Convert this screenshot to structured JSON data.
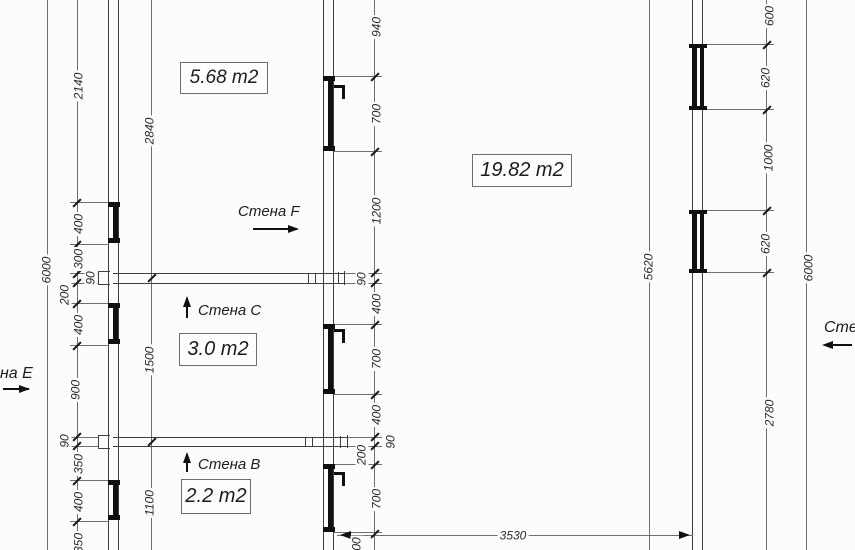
{
  "rooms": [
    {
      "label": "5.68 m2"
    },
    {
      "label": "19.82 m2"
    },
    {
      "label": "3.0 m2"
    },
    {
      "label": "2.2 m2"
    }
  ],
  "wall_labels": [
    {
      "text": "Стена F",
      "arrow": "right"
    },
    {
      "text": "Стена C",
      "arrow": "up"
    },
    {
      "text": "Стена B",
      "arrow": "up"
    },
    {
      "text": "на Е",
      "arrow": "right"
    },
    {
      "text": "Сте",
      "arrow": "left"
    }
  ],
  "dimensions": [
    {
      "t": "2140",
      "x": 79,
      "y": 86,
      "r": 1
    },
    {
      "t": "2840",
      "x": 150,
      "y": 131,
      "r": 1
    },
    {
      "t": "6000",
      "x": 47,
      "y": 270,
      "r": 1
    },
    {
      "t": "400",
      "x": 79,
      "y": 224,
      "r": 1
    },
    {
      "t": "300",
      "x": 79,
      "y": 259,
      "r": 1
    },
    {
      "t": "90",
      "x": 91,
      "y": 278,
      "r": 1
    },
    {
      "t": "200",
      "x": 65,
      "y": 295,
      "r": 1
    },
    {
      "t": "400",
      "x": 79,
      "y": 325,
      "r": 1
    },
    {
      "t": "900",
      "x": 76,
      "y": 390,
      "r": 1
    },
    {
      "t": "90",
      "x": 65,
      "y": 441,
      "r": 1
    },
    {
      "t": "350",
      "x": 79,
      "y": 464,
      "r": 1
    },
    {
      "t": "400",
      "x": 79,
      "y": 502,
      "r": 1
    },
    {
      "t": "350",
      "x": 79,
      "y": 543,
      "r": 1
    },
    {
      "t": "1500",
      "x": 150,
      "y": 360,
      "r": 1
    },
    {
      "t": "1100",
      "x": 150,
      "y": 503,
      "r": 1
    },
    {
      "t": "940",
      "x": 377,
      "y": 27,
      "r": 1
    },
    {
      "t": "700",
      "x": 377,
      "y": 114,
      "r": 1
    },
    {
      "t": "1200",
      "x": 377,
      "y": 211,
      "r": 1
    },
    {
      "t": "90",
      "x": 362,
      "y": 279,
      "r": 1
    },
    {
      "t": "400",
      "x": 377,
      "y": 304,
      "r": 1
    },
    {
      "t": "700",
      "x": 377,
      "y": 359,
      "r": 1
    },
    {
      "t": "400",
      "x": 377,
      "y": 415,
      "r": 1
    },
    {
      "t": "90",
      "x": 391,
      "y": 442,
      "r": 1
    },
    {
      "t": "200",
      "x": 362,
      "y": 455,
      "r": 1
    },
    {
      "t": "700",
      "x": 377,
      "y": 499,
      "r": 1
    },
    {
      "t": "00",
      "x": 357,
      "y": 544,
      "r": 1
    },
    {
      "t": "3530",
      "x": 513,
      "y": 536,
      "r": 0
    },
    {
      "t": "5620",
      "x": 649,
      "y": 267,
      "r": 1
    },
    {
      "t": "600",
      "x": 770,
      "y": 16,
      "r": 1
    },
    {
      "t": "620",
      "x": 766,
      "y": 78,
      "r": 1
    },
    {
      "t": "1000",
      "x": 769,
      "y": 158,
      "r": 1
    },
    {
      "t": "620",
      "x": 766,
      "y": 244,
      "r": 1
    },
    {
      "t": "2780",
      "x": 770,
      "y": 413,
      "r": 1
    },
    {
      "t": "6000",
      "x": 809,
      "y": 268,
      "r": 1
    }
  ]
}
